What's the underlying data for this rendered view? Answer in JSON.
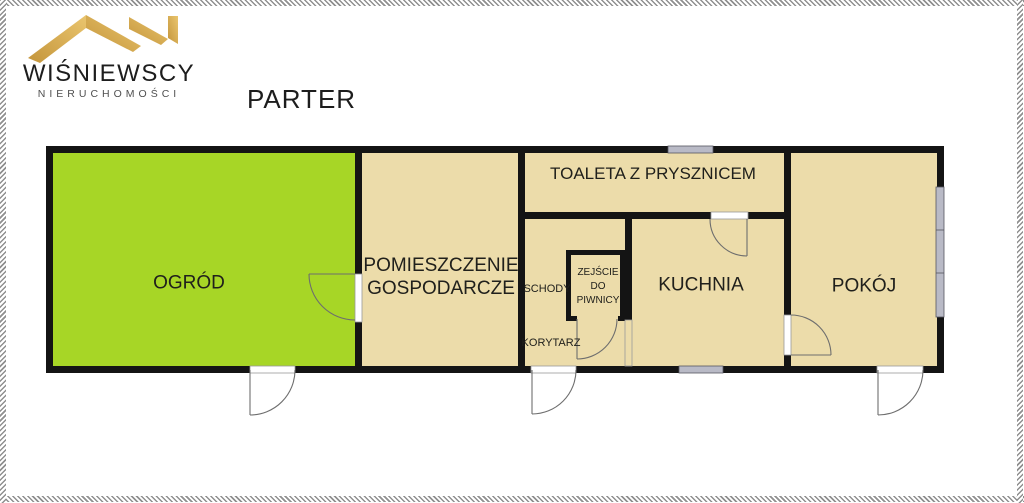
{
  "theme": {
    "garden-green": "#a7d626",
    "floor-beige": "#ecdcaa",
    "wall-black": "#141414",
    "window-gray": "#b9bac6",
    "door-line": "#6e6e6e",
    "gold-dark": "#c4953b",
    "gold-light": "#eac56e",
    "text-dark": "#1d1d1d",
    "text-gray": "#4f4f4f",
    "hatch-gray": "#8f8f8f"
  },
  "header": {
    "brand_name": "WIŚNIEWSCY",
    "brand_tagline": "NIERUCHOMOŚCI",
    "floor_title": "PARTER"
  },
  "plan": {
    "rooms": {
      "ogrod": {
        "label": "OGRÓD"
      },
      "pomieszczenie": {
        "lines": [
          "POMIESZCZENIE",
          "GOSPODARCZE"
        ]
      },
      "toaleta": {
        "label": "TOALETA Z PRYSZNICEM"
      },
      "schody": {
        "label": "SCHODY"
      },
      "zejscie": {
        "lines": [
          "ZEJŚCIE",
          "DO",
          "PIWNICY"
        ]
      },
      "korytarz": {
        "label": "KORYTARZ"
      },
      "kuchnia": {
        "label": "KUCHNIA"
      },
      "pokoj": {
        "label": "POKÓJ"
      }
    }
  }
}
